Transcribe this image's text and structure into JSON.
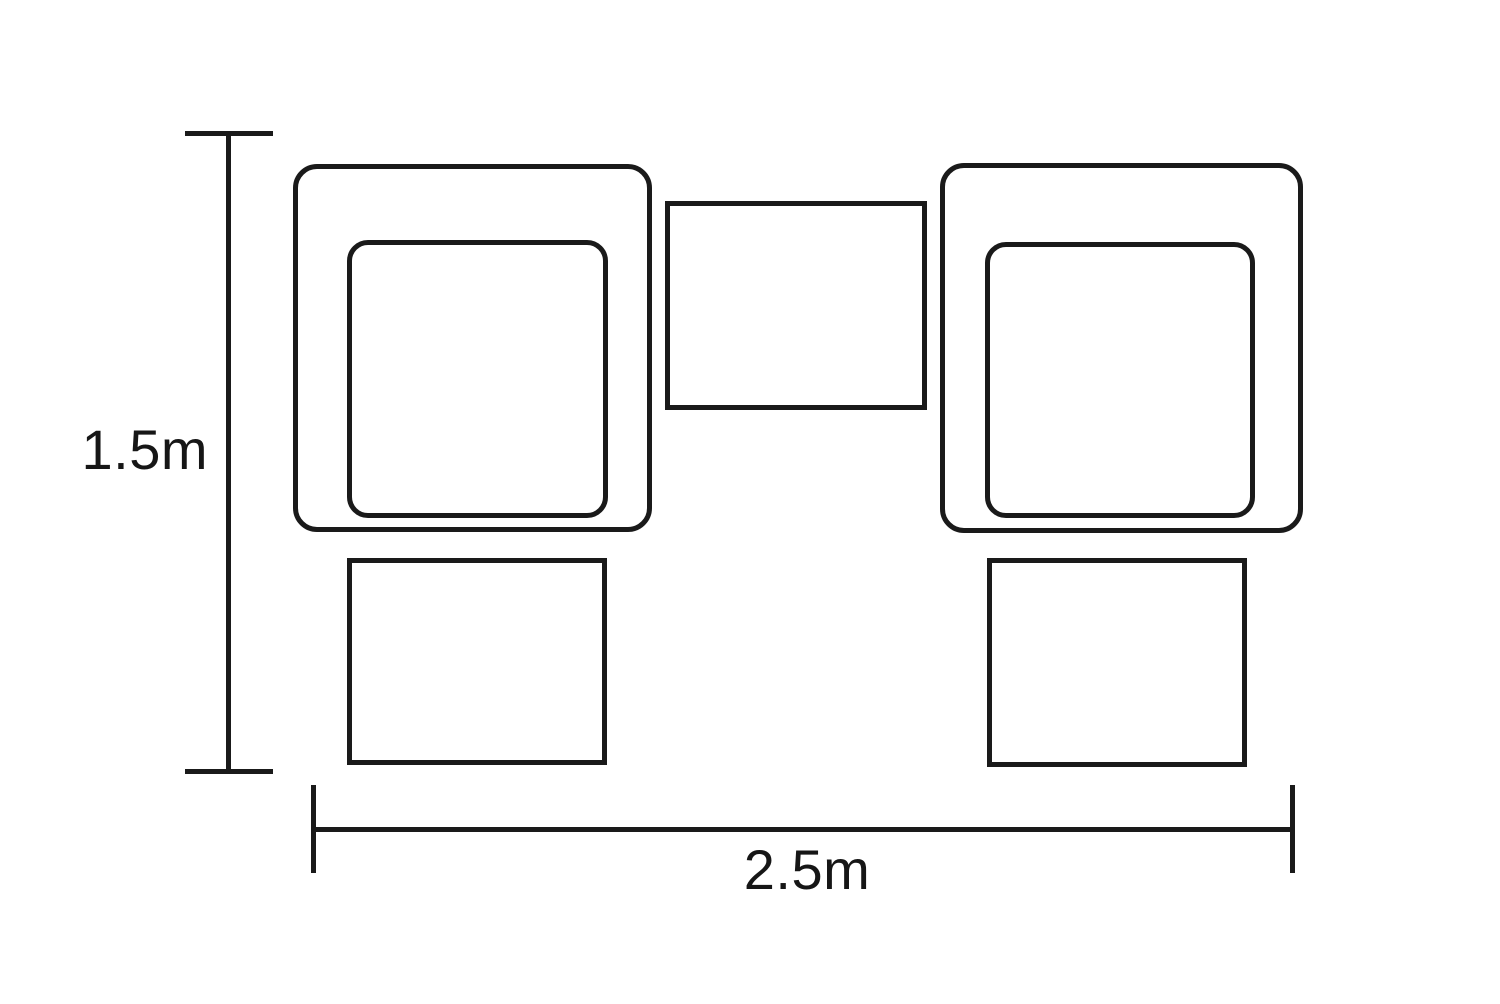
{
  "diagram": {
    "description": "Top-view furniture set dimension drawing: two armchairs with seat cushions, a center table, and two footstools",
    "background_color": "#ffffff",
    "stroke_color": "#1a1a1a",
    "dimensions": {
      "height_label": "1.5m",
      "width_label": "2.5m"
    },
    "shapes": [
      {
        "name": "left-armchair"
      },
      {
        "name": "left-armchair-seat"
      },
      {
        "name": "center-table"
      },
      {
        "name": "right-armchair"
      },
      {
        "name": "right-armchair-seat"
      },
      {
        "name": "left-footstool"
      },
      {
        "name": "right-footstool"
      }
    ]
  }
}
